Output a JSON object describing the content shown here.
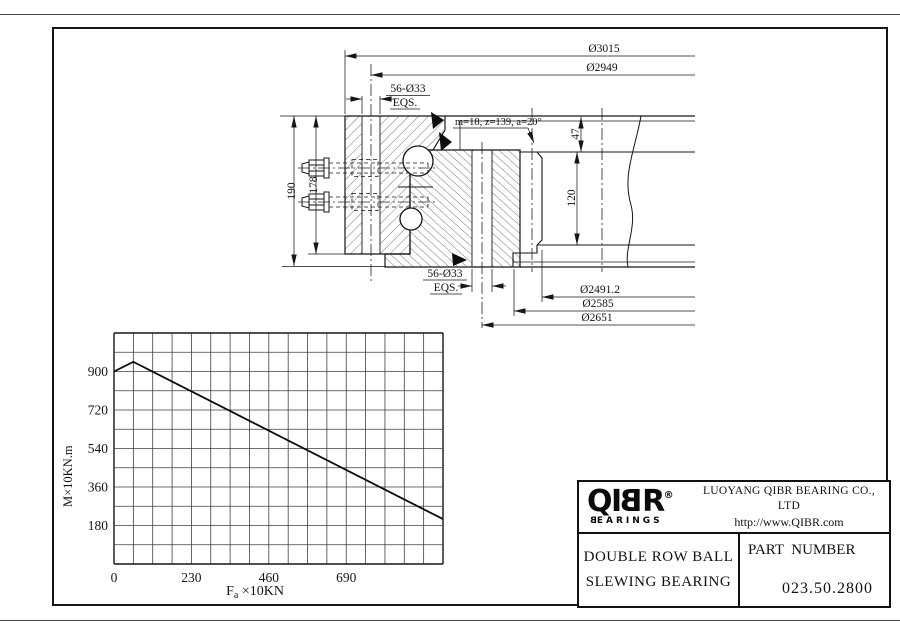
{
  "title_block": {
    "logo": {
      "letters": [
        "Q",
        "I",
        "B",
        "R"
      ],
      "reg_mark": "®",
      "brand_first": "B",
      "brand_rest": "EARINGS"
    },
    "company": "LUOYANG QIBR BEARING CO., LTD",
    "website": "http://www.QIBR.com",
    "product_line1": "DOUBLE ROW BALL",
    "product_line2": "SLEWING BEARING",
    "part_label": "PART  NUMBER",
    "part_number": "023.50.2800"
  },
  "drawing": {
    "dim_d3015": "Ø3015",
    "dim_d2949": "Ø2949",
    "dim_holes_top": "56-Ø33",
    "dim_eqs_top": "EQS.",
    "gear_spec": "m=18, z=139, a=20°",
    "dim_47": "47",
    "dim_120": "120",
    "dim_190": "190",
    "dim_178": "178",
    "dim_holes_bottom": "56-Ø33",
    "dim_eqs_bottom": "EQS.",
    "dim_d2491": "Ø2491.2",
    "dim_d2585": "Ø2585",
    "dim_d2651": "Ø2651"
  },
  "chart_data": {
    "type": "line",
    "xlabel": "Fa ×10KN",
    "xlabel_pre": "F",
    "xlabel_sub": "a",
    "xlabel_post": " ×10KN",
    "ylabel": "M×10KN.m",
    "x_ticks": [
      0,
      230,
      460,
      690
    ],
    "y_ticks": [
      180,
      360,
      540,
      720,
      900
    ],
    "x_max": 977.5,
    "y_max": 1080,
    "x_grid_step": 57.5,
    "y_grid_step": 90,
    "grid": true,
    "legend_position": "none",
    "line_color": "#0b0b0b",
    "series": [
      {
        "name": "moment vs axial load capacity",
        "points": [
          [
            0,
            900
          ],
          [
            57.5,
            945
          ],
          [
            977.5,
            210
          ]
        ]
      }
    ]
  }
}
